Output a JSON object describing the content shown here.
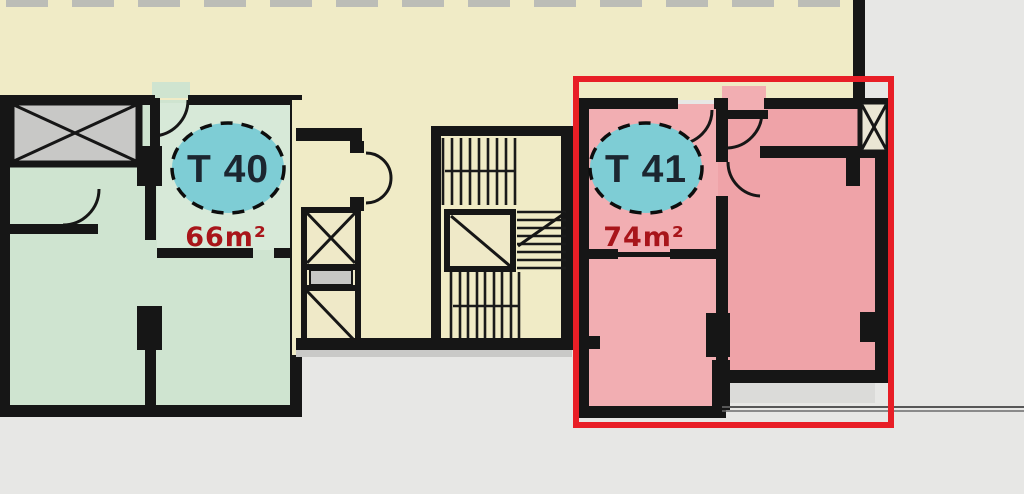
{
  "plan": {
    "title": "apartment-floor-plan",
    "units": [
      {
        "id": "t40",
        "label": "T 40",
        "area": "66m²",
        "highlighted": false,
        "room_fill": "#cfe4d0",
        "badge_fill": "#7ecdd5",
        "area_text_color": "#a8151a"
      },
      {
        "id": "t41",
        "label": "T 41",
        "area": "74m²",
        "highlighted": true,
        "room_fill": "#efa3a8",
        "badge_fill": "#7ecdd5",
        "area_text_color": "#a8151a"
      }
    ],
    "highlight": {
      "color": "#e81e26",
      "style": "red-rectangle-outline"
    },
    "colors": {
      "canvas_background": "#e7e7e5",
      "corridor": "#f0ebc6",
      "wall": "#161616",
      "shaft_fill": "#c8c8c6",
      "badge_border": "#0d0d0d"
    },
    "symbols": [
      {
        "name": "elevator-shaft-icon",
        "glyph": "crossed-box"
      },
      {
        "name": "stairs-icon",
        "glyph": "parallel-treads"
      },
      {
        "name": "service-shaft-icon",
        "glyph": "crossed-box"
      }
    ]
  }
}
